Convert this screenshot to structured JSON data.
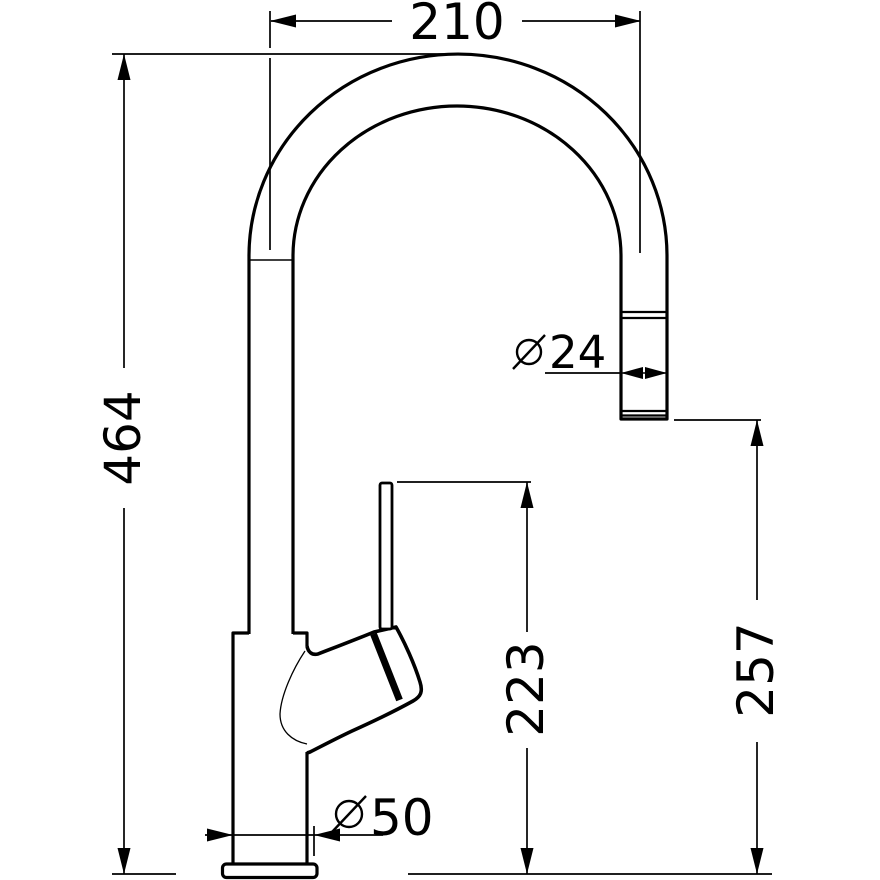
{
  "drawing": {
    "background_color": "#ffffff",
    "line_color": "#000000",
    "diameter_symbol": "⌀",
    "dimensions": {
      "spout_reach": {
        "label": "210",
        "location": "top-horizontal"
      },
      "overall_height": {
        "label": "464",
        "location": "left-vertical"
      },
      "spout_diameter": {
        "symbol": "⌀",
        "label": "24",
        "location": "spout-outlet"
      },
      "handle_height": {
        "label": "223",
        "location": "middle-vertical"
      },
      "outlet_height": {
        "label": "257",
        "location": "right-vertical"
      },
      "base_diameter": {
        "symbol": "⌀",
        "label": "50",
        "location": "base"
      }
    }
  }
}
